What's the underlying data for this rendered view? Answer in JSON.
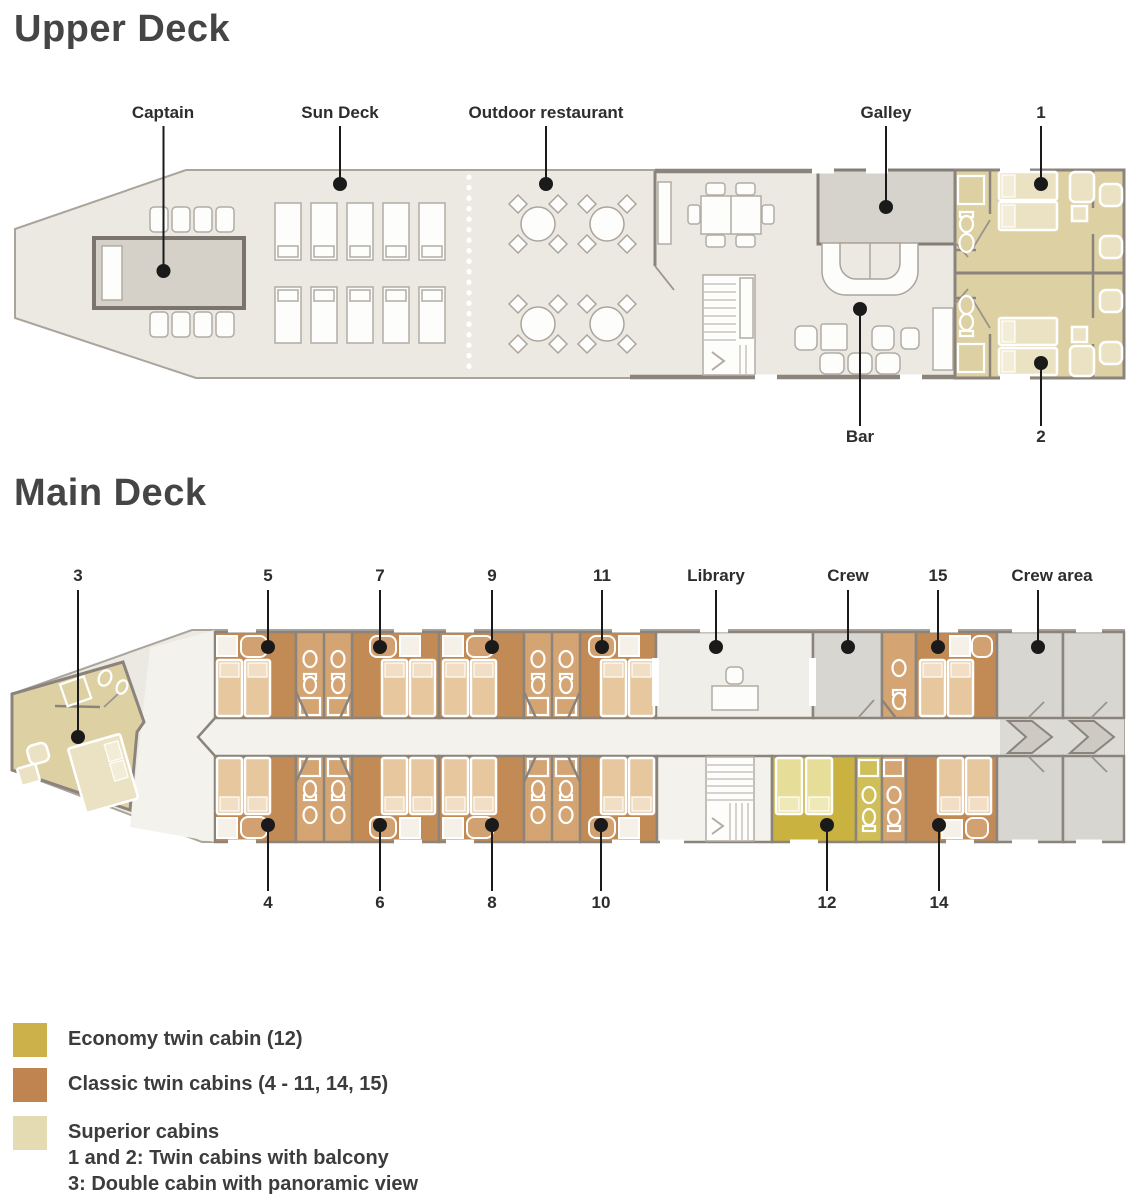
{
  "decks": {
    "upper": {
      "title": "Upper Deck",
      "labels": {
        "captain": "Captain",
        "sun_deck": "Sun Deck",
        "outdoor_restaurant": "Outdoor restaurant",
        "galley": "Galley",
        "cabin_1": "1",
        "bar": "Bar",
        "cabin_2": "2"
      }
    },
    "main": {
      "title": "Main Deck",
      "labels": {
        "cabin_3": "3",
        "cabin_5": "5",
        "cabin_7": "7",
        "cabin_9": "9",
        "cabin_11": "11",
        "library": "Library",
        "crew": "Crew",
        "cabin_15": "15",
        "crew_area": "Crew area",
        "cabin_4": "4",
        "cabin_6": "6",
        "cabin_8": "8",
        "cabin_10": "10",
        "cabin_12": "12",
        "cabin_14": "14"
      }
    }
  },
  "legend": {
    "items": [
      {
        "color": "#CCB14B",
        "lines": [
          "Economy twin cabin (12)"
        ]
      },
      {
        "color": "#BF8450",
        "lines": [
          "Classic twin cabins (4 - 11, 14, 15)"
        ]
      },
      {
        "color": "#E4DBB3",
        "lines": [
          "Superior cabins",
          "1 and 2: Twin cabins with balcony",
          "3: Double cabin with panoramic view"
        ]
      }
    ]
  },
  "palette": {
    "economy_floor": "#C9B240",
    "classic_floor": "#C28A54",
    "superior_floor": "#DDD1A4",
    "crew_room": "#D8D6D0",
    "deck_floor": "#ECE9E2"
  }
}
